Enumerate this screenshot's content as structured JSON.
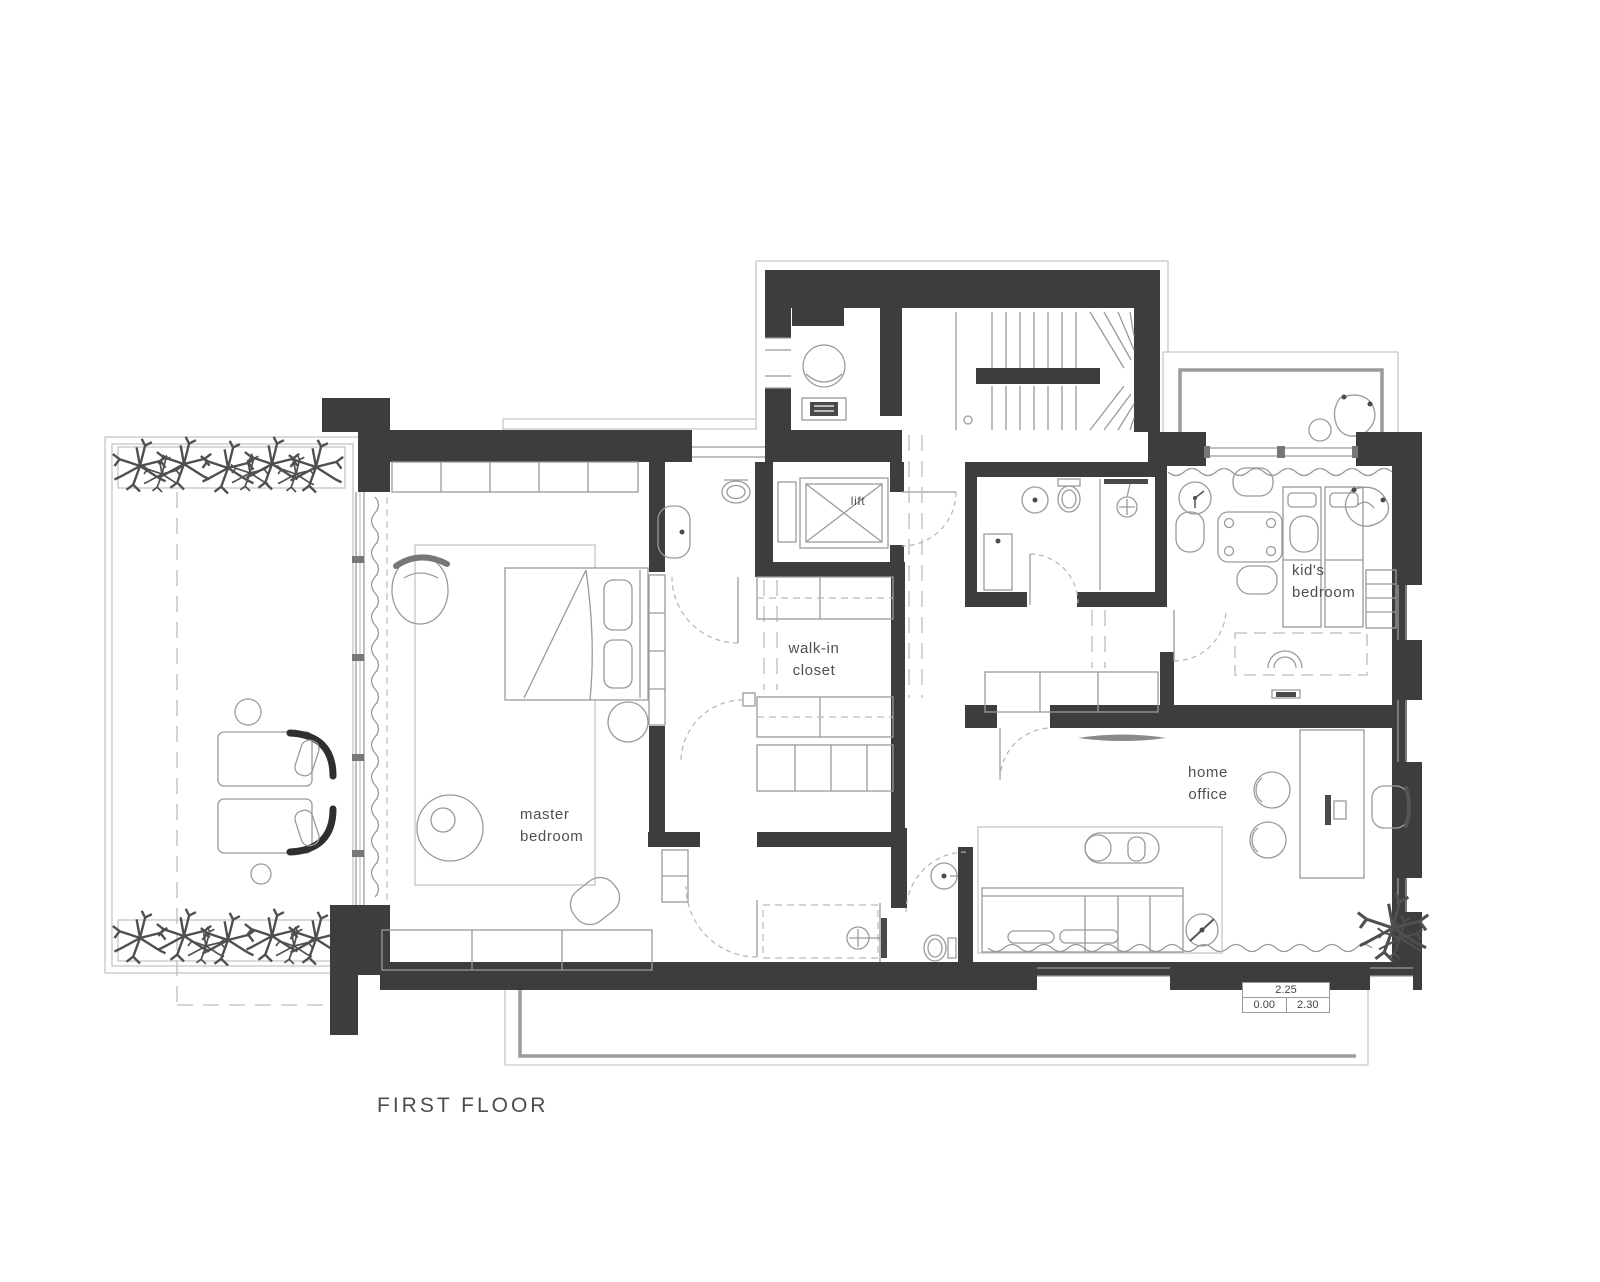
{
  "floor_title": "FIRST FLOOR",
  "rooms": {
    "master_bedroom": "master bedroom",
    "walk_in_closet": "walk-in closet",
    "lift": "lift",
    "kids_bedroom": "kid's bedroom",
    "home_office": "home office"
  },
  "level_markers": {
    "top": "2.25",
    "bottom_left": "0.00",
    "bottom_right": "2.30"
  },
  "colors": {
    "wall": "#3d3d3d",
    "line": "#9a9a9a",
    "faint_line": "#c6c6c6",
    "text": "#4f4f4f",
    "accent_dark": "#2f2f2f",
    "background": "#ffffff"
  }
}
